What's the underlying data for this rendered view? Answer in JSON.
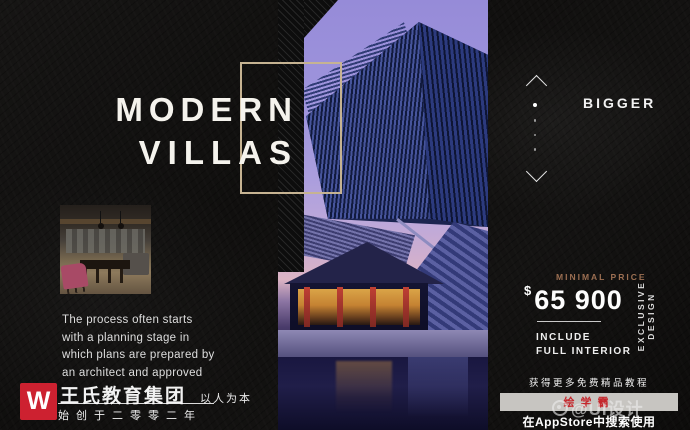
{
  "title": {
    "line1": "MODERN",
    "line2": "VILLAS"
  },
  "right_rail": {
    "bigger": "BIGGER"
  },
  "price": {
    "label": "MINIMAL PRICE",
    "currency": "$",
    "amount": "65 900",
    "include1": "INCLUDE",
    "include2": "FULL INTERIOR",
    "exclusive_vertical": "EXCLUSIVE DESIGN"
  },
  "description": {
    "lines": [
      "The process often starts",
      "with a planning stage in",
      "which plans are prepared by",
      "an architect and approved"
    ]
  },
  "brand": {
    "logo_letter": "W",
    "name": "王氏教育集团",
    "slogan": "以人为本",
    "since": "始创于二零零二年"
  },
  "promo": {
    "headline": "获得更多免费精品教程",
    "app_badge": "绘学霸",
    "store_line": "在AppStore中搜索使用",
    "watermark": "@UI设计"
  },
  "colors": {
    "accent_gold": "#c6b392",
    "price_label_tan": "#9c6f52",
    "brand_red": "#cd2130",
    "badge_bar_gray": "#c7c5c1",
    "badge_text_red": "#c5262b",
    "sky_purple": "#a096dd",
    "background_black": "#100f0e"
  }
}
